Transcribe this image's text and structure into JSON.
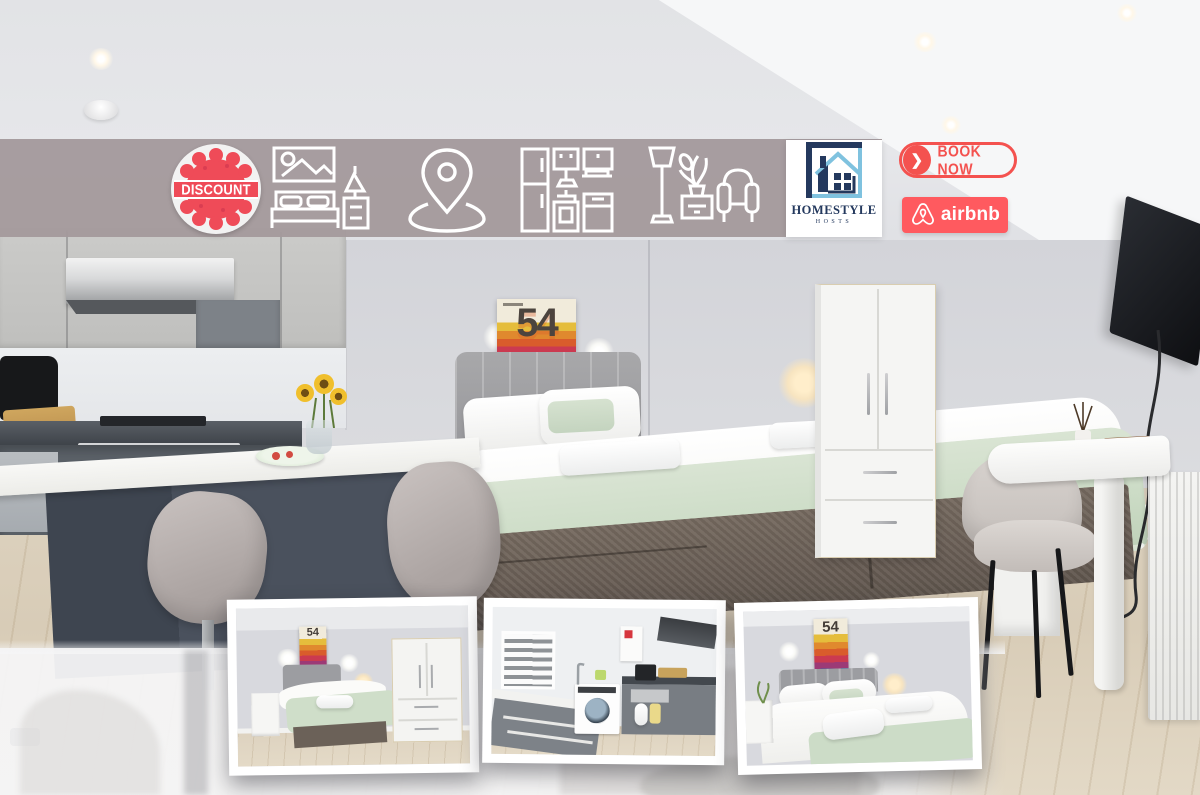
{
  "banner": {
    "background_color": "#a49a9c",
    "discount_badge": {
      "label": "DISCOUNT",
      "badge_color": "#ef4b58"
    },
    "icons": [
      {
        "name": "bedroom-photo-icon"
      },
      {
        "name": "location-pin-icon"
      },
      {
        "name": "kitchen-units-icon"
      },
      {
        "name": "living-room-furniture-icon"
      }
    ],
    "homestyle_logo": {
      "line1": "HOMESTYLE",
      "line2": "HOSTS",
      "navy": "#24395e",
      "light_blue": "#7fc2df"
    },
    "book_now_button": {
      "label": "BOOK NOW",
      "chevron": "❯",
      "color": "#f4524f"
    },
    "airbnb_badge": {
      "label": "airbnb",
      "background": "#ff5a5f"
    }
  },
  "photo": {
    "poster_number": "54",
    "scene": "studio apartment with kitchen, double bed, wardrobe, desk and wall TV",
    "thumbnails": [
      {
        "name": "bedroom-with-wardrobe"
      },
      {
        "name": "kitchen-with-washing-machine"
      },
      {
        "name": "bed-close-up"
      }
    ]
  },
  "colors": {
    "wall": "#d6d7db",
    "sage_throw": "#ccdcc6",
    "wood_floor": "#d9cebb",
    "island": "#47505c"
  }
}
